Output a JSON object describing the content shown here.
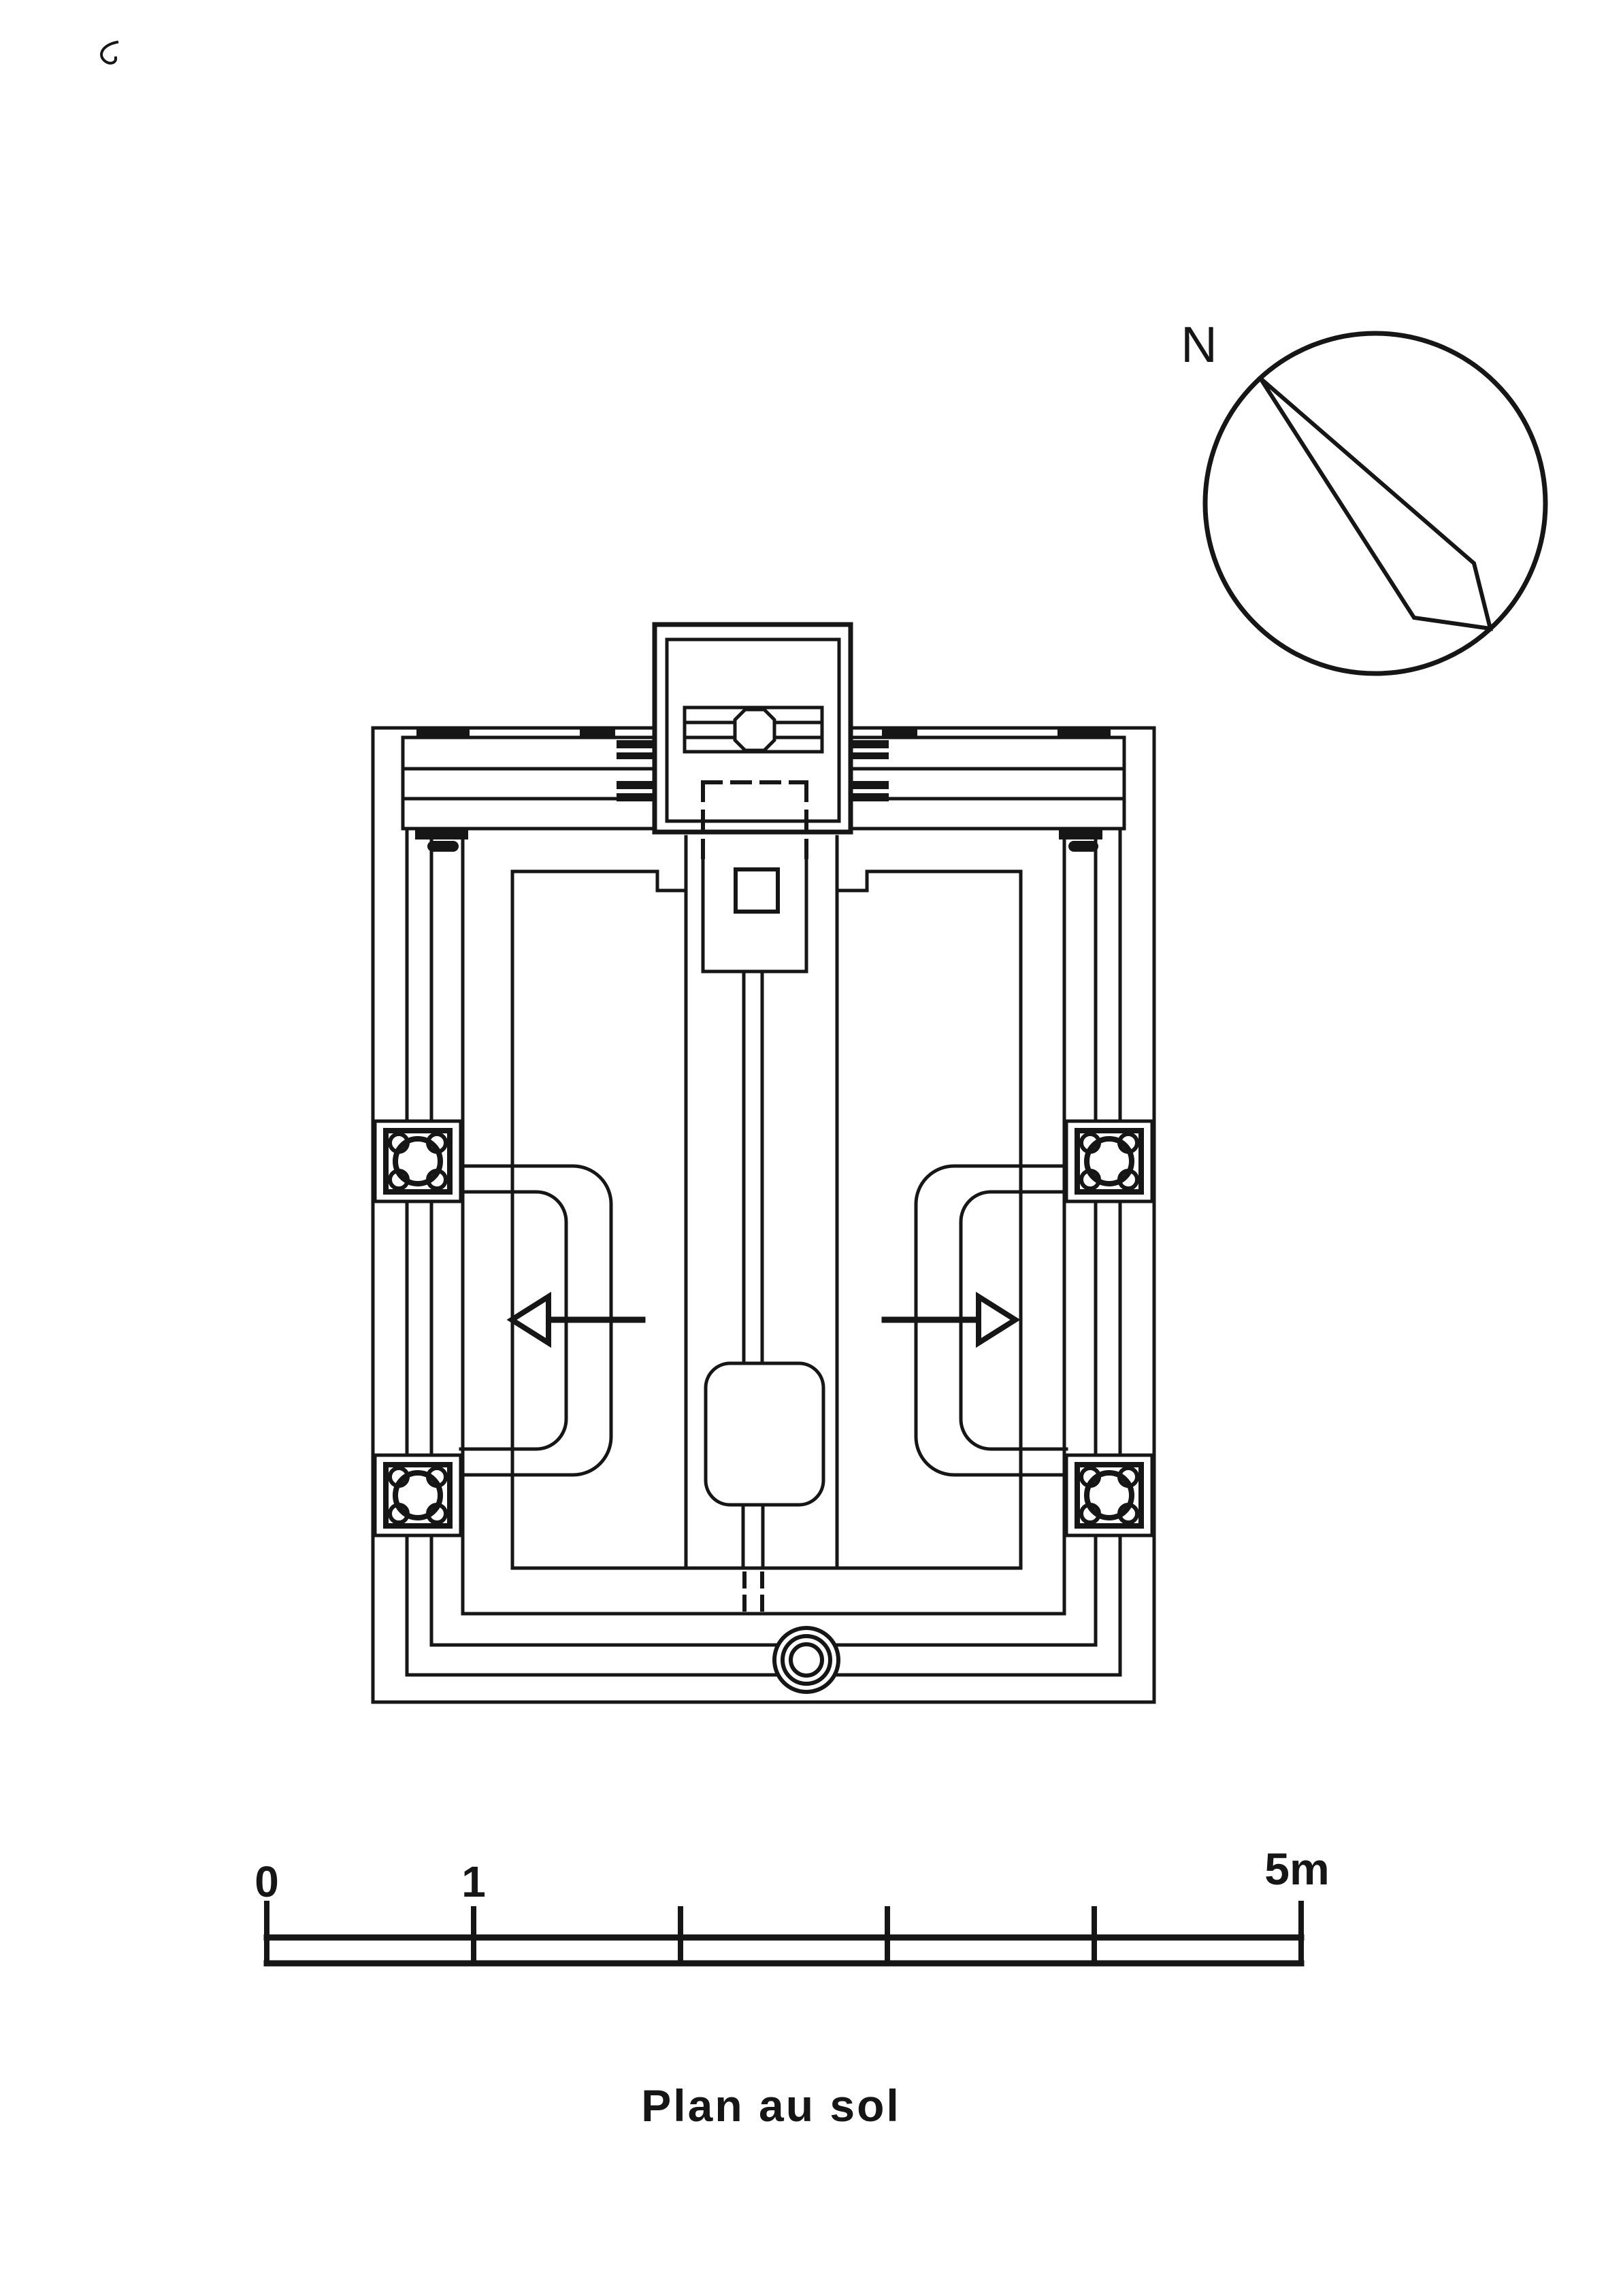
{
  "canvas": {
    "background": "#ffffff",
    "ink": "#161616"
  },
  "compass": {
    "label": "N"
  },
  "scale_bar": {
    "labels": [
      "0",
      "1",
      "5m"
    ],
    "tick_values": [
      0,
      1,
      2,
      3,
      4,
      5
    ],
    "unit": "m"
  },
  "caption": {
    "title": "Plan au sol"
  }
}
